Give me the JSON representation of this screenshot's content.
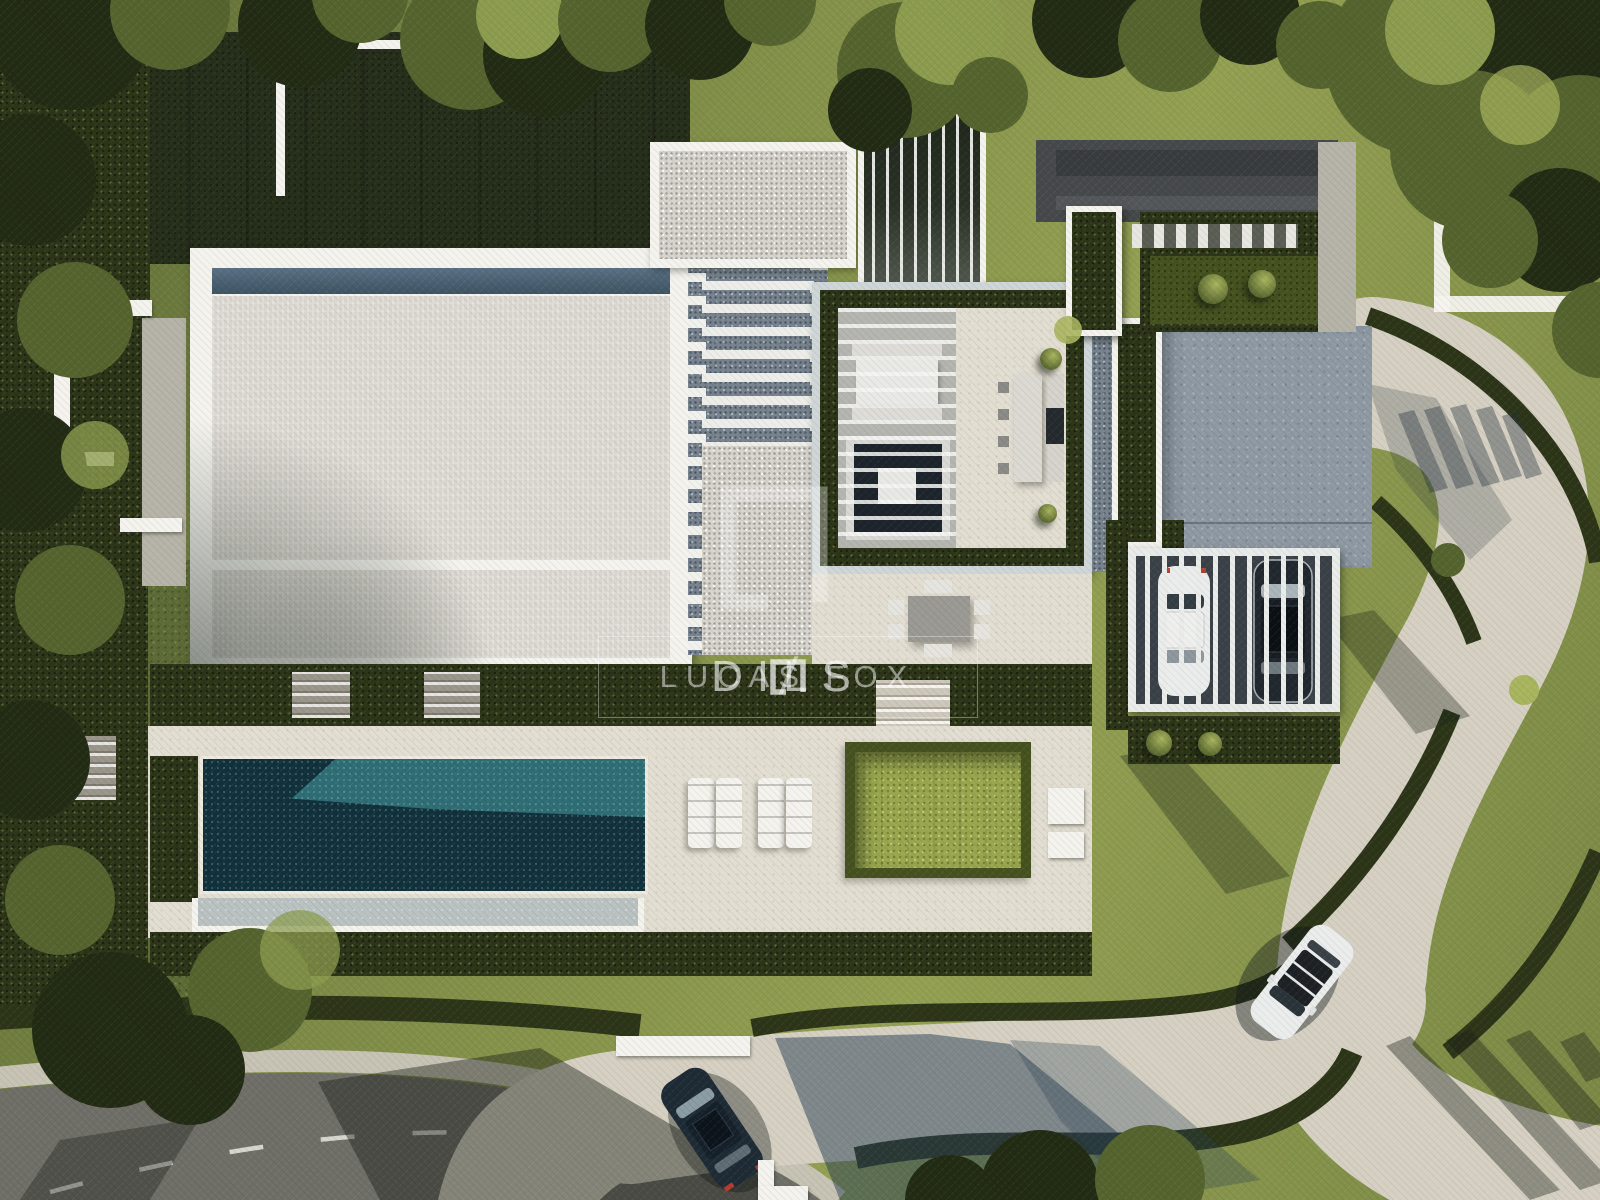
{
  "watermark": {
    "brand_primary": "DILS",
    "separator": "/",
    "brand_secondary": "LUCAS FOX",
    "logo": "dils-square-bracket"
  },
  "scene": {
    "type": "aerial-architectural-render",
    "objects": [
      "villa-gravel-roof",
      "pergola-roof",
      "open-courtyard",
      "vertical-slat-screen",
      "swimming-pool",
      "sun-loungers",
      "lawn-square",
      "outdoor-kitchen",
      "dining-terrace",
      "carport",
      "white-sports-car",
      "dark-suv-carport",
      "white-suv-driveway",
      "dark-suv-street",
      "curved-driveway",
      "street-road",
      "hedges",
      "trees"
    ]
  },
  "colors": {
    "grassBase": "#7b8845",
    "grassLight": "#93a052",
    "grassDark": "#5d6b36",
    "lawnShadow": "#262f1a",
    "hedgeDark": "#2c3518",
    "hedgeMid": "#45521f",
    "hedgeBright": "#9aa74e",
    "treeDark": "#222b14",
    "treeMid": "#55642e",
    "treeLight": "#8c9c4f",
    "treeHighlight": "#a9b55e",
    "white": "#f4f3ee",
    "cream": "#e3ded2",
    "gravel": "#d8d5ce",
    "pathGrey": "#b6b3a8",
    "skylight": "#4d6375",
    "paveBlue": "#8e99a3",
    "paveBlueDark": "#77838e",
    "entryDark": "#46494b",
    "carportFloor": "#3a4147",
    "poolLight": "#2e6d74",
    "poolDark": "#10313c",
    "poolLedge": "#b9c1c1",
    "asphalt": "#6f6f68",
    "curb": "#c7c3b4",
    "driveway": "#d5d0c2",
    "carWhite": "#ebedec",
    "suvNavy": "#1e2b35"
  }
}
